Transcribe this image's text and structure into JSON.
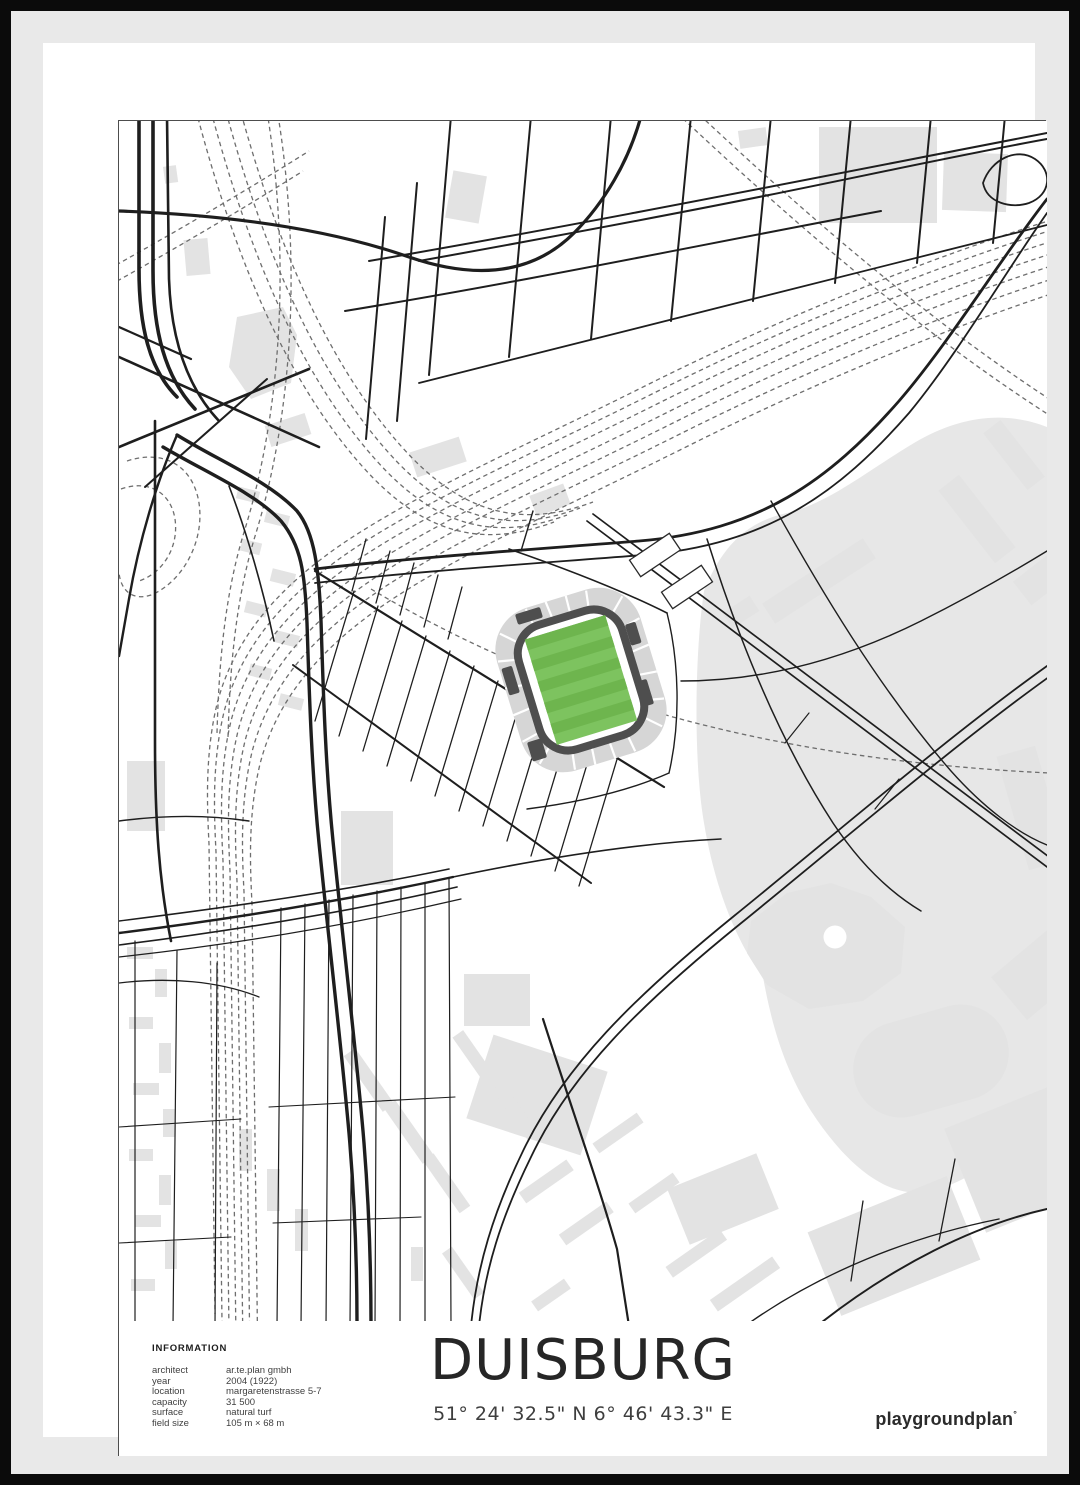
{
  "poster": {
    "title": "DUISBURG",
    "coordinates": "51° 24' 32.5\" N 6° 46' 43.3\" E",
    "brand": "playgroundplan",
    "brand_mark": "°"
  },
  "information": {
    "heading": "INFORMATION",
    "rows": [
      {
        "label": "architect",
        "value": "ar.te.plan gmbh"
      },
      {
        "label": "year",
        "value": "2004 (1922)"
      },
      {
        "label": "location",
        "value": "margaretenstrasse 5-7"
      },
      {
        "label": "capacity",
        "value": "31 500"
      },
      {
        "label": "surface",
        "value": "natural turf"
      },
      {
        "label": "field size",
        "value": "105 m × 68 m"
      }
    ]
  },
  "colors": {
    "frame": "#0b0b0b",
    "mat": "#e9e9e9",
    "paper": "#ffffff",
    "border": "#4d4d4d",
    "road": "#1e1e1e",
    "railway": "#6e6e6e",
    "building": "#e3e3e3",
    "park": "#e7e7e7",
    "stadium_ring": "#d6d6d6",
    "stadium_dark": "#4e4e4e",
    "pitch_light": "#7dc35f",
    "pitch_dark": "#6eb54e",
    "title_color": "#262626",
    "text_color": "#3c3c3c"
  }
}
